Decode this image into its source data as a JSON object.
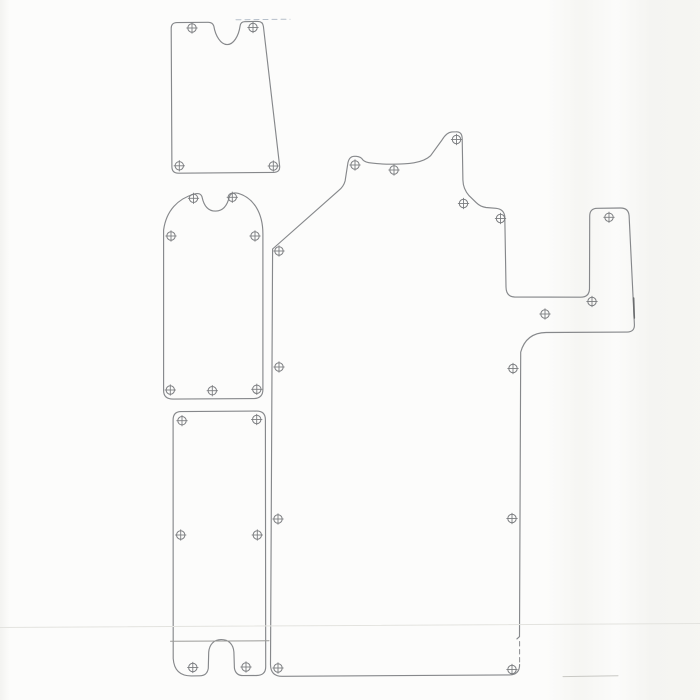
{
  "page": {
    "background": "#fcfcfb",
    "line_color": "#86888b",
    "hole_color": "#7c7e81",
    "stroke_width": 1.15,
    "hole_radius": 4.2,
    "cross_overhang": 1.4
  },
  "drawing": {
    "canvas": {
      "width": 700,
      "height": 700
    },
    "shapes": [
      {
        "name": "panel-top-left",
        "description": "small trapezoid panel with semicircular top notch",
        "path": "M 177,22.6 L 208,22.3 Q 212.6,22.2 213.8,26 C 215.4,35.8 220.7,44.6 227.1,44.6 C 233.5,44.6 238.6,36.2 240.1,26 Q 240.7,21.8 244.5,21.7 L 257.5,21.4 Q 262.7,21.2 263.4,26.4 L 279.6,165.8 Q 280.4,172.2 273.8,172.4 L 178.5,173.2 Q 172,173.3 171.9,166.8 L 171.2,28.4 Q 171.1,22.7 177,22.6 Z",
        "holes": [
          [
            192,
            28
          ],
          [
            253,
            27.5
          ],
          [
            179.3,
            165.8
          ],
          [
            273.3,
            166
          ]
        ]
      },
      {
        "name": "panel-middle-left",
        "description": "dome-top panel with center notch",
        "path": "M 163.6,230 L 163.6,390.5 Q 163.6,399 173,399.1 L 253.5,398.6 Q 262.9,398.5 262.9,389.5 L 262.9,234 C 262.9,213 253.5,197.8 238.5,193.4 Q 231.4,191.6 229.4,196.5 C 227.8,203.5 224.3,210.9 215.8,211.1 C 207.2,211.3 203.6,204.2 202.1,197.2 Q 200.7,192.2 194.3,194 C 177.8,198.8 166.3,210.5 163.6,230 Z",
        "holes": [
          [
            193.5,
            198.3
          ],
          [
            232.3,
            197.3
          ],
          [
            171,
            236
          ],
          [
            255,
            236
          ],
          [
            170.3,
            390
          ],
          [
            212.3,
            390.7
          ],
          [
            256.8,
            389.3
          ]
        ]
      },
      {
        "name": "panel-bottom-left",
        "description": "long panel with bottom slot",
        "path": "M 181,411.6 L 256.5,411.1 Q 265.3,411 265.4,419.6 L 265.7,666.8 Q 265.7,675.4 256.6,675.5 L 243.2,675.6 Q 235.6,675.6 234.4,668 L 233.9,652 C 233.2,643.6 228.2,639.6 221.2,639.6 C 214.2,639.6 209.4,644.1 208.7,652.2 L 208.3,668.2 Q 207.2,675.8 199.6,675.8 L 191.6,675.9 Q 174.4,676.1 173.2,658.5 L 173.1,419.9 Q 173.1,411.7 181,411.6 Z",
        "holes": [
          [
            182,
            420.7
          ],
          [
            256.7,
            419.5
          ],
          [
            180.7,
            535
          ],
          [
            257.3,
            535
          ],
          [
            192.8,
            667.5
          ],
          [
            246,
            667
          ]
        ]
      },
      {
        "name": "panel-main",
        "description": "large stepped panel with rectangular cutout and right arm",
        "path": "M 272.6,249 L 338.6,190.6 Q 343.6,186.6 345.1,181 L 347.7,164.2 Q 348.7,156.6 354,156.3 L 356.2,156.3 Q 361,156.7 362.7,159.7 Q 365.2,162.5 372,163.1 C 383,164.5 402,164.7 414,162.8 Q 425,161 430.6,155.7 L 442,140 Q 446.6,132.2 452,131.9 L 456,131.8 Q 462,131.5 462.2,138.5 L 462.9,180 Q 463.1,189 469.1,195.7 L 476.3,202.7 Q 480.3,206.7 486,207.5 L 496,208.3 Q 504,209.1 504.8,216.7 L 506,287 Q 506.2,296.7 514.5,297 L 580.6,297.2 Q 589.3,297.2 589.5,288.7 L 589.7,216.1 Q 589.7,208.5 597.1,208.3 L 620.6,208 Q 628.5,208 629.1,215.7 L 634.4,324.6 Q 634.7,331.9 627.1,332.1 L 546.1,332.5 Q 526.1,332.8 520.7,352.1 L 519.5,636.6 L 516.9,638.9 M 519.6,664.6 Q 519.6,674.7 509.6,674.9 L 282.1,676.3 Q 270.7,676.3 270.5,664.7 L 272.6,249",
        "holes": [
          [
            279,
            251
          ],
          [
            355,
            165
          ],
          [
            394,
            170
          ],
          [
            456.5,
            139.5
          ],
          [
            463.5,
            203.5
          ],
          [
            500.5,
            218.5
          ],
          [
            609,
            217.3
          ],
          [
            592,
            301.5
          ],
          [
            545,
            314
          ],
          [
            513,
            368.5
          ],
          [
            279,
            367
          ],
          [
            278,
            519
          ],
          [
            512,
            518.5
          ],
          [
            278,
            668
          ],
          [
            512,
            669.5
          ]
        ]
      }
    ],
    "artifacts": [
      {
        "name": "scan-streak-horizontal",
        "x1": 0,
        "y1": 627.5,
        "x2": 700,
        "y2": 623.5,
        "color": "#e3e3df",
        "width": 1,
        "dash": ""
      },
      {
        "name": "crease-line-bottom-panel",
        "x1": 170.5,
        "y1": 641.3,
        "x2": 269,
        "y2": 640.8,
        "color": "#9b9b98",
        "width": 1,
        "dash": ""
      },
      {
        "name": "dashed-edge-extension-top",
        "x1": 236,
        "y1": 19.8,
        "x2": 290,
        "y2": 19.2,
        "color": "#b5bfca",
        "width": 1,
        "dash": "5 4"
      },
      {
        "name": "dashed-right-edge-segment",
        "x1": 519.6,
        "y1": 641.5,
        "x2": 519.6,
        "y2": 663,
        "color": "#8a8c8f",
        "width": 1,
        "dash": "4.5 3.5"
      },
      {
        "name": "print-smear-bottom-right",
        "x1": 563,
        "y1": 676.6,
        "x2": 618,
        "y2": 675.8,
        "color": "#c8c8c4",
        "width": 1,
        "dash": ""
      },
      {
        "name": "ink-thick-segment-right-arm",
        "x1": 633.6,
        "y1": 298,
        "x2": 634.3,
        "y2": 318,
        "color": "#6a6c6e",
        "width": 1.6,
        "dash": ""
      }
    ]
  }
}
